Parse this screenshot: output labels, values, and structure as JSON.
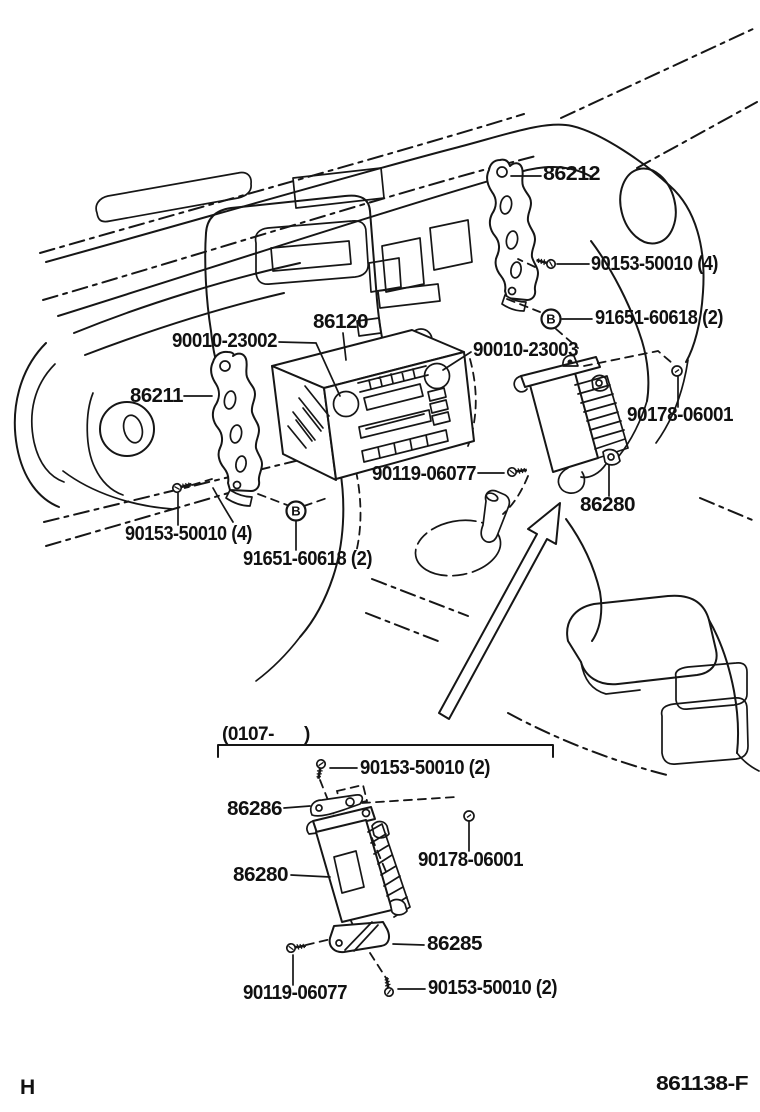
{
  "diagram": {
    "figure_code": "861138-F",
    "page_letter": "H",
    "subsection": {
      "open": "(0107-",
      "close": ")"
    },
    "fastener_symbol": "B",
    "callouts": [
      "86212",
      "90153-50010 (4)",
      "91651-60618 (2)",
      "86120",
      "90010-23002",
      "90010-23003",
      "90178-06001",
      "86211",
      "90119-06077",
      "86280",
      "90153-50010 (4)",
      "91651-60618 (2)",
      "90153-50010 (2)",
      "86286",
      "90178-06001",
      "86280",
      "86285",
      "90119-06077",
      "90153-50010 (2)"
    ]
  }
}
